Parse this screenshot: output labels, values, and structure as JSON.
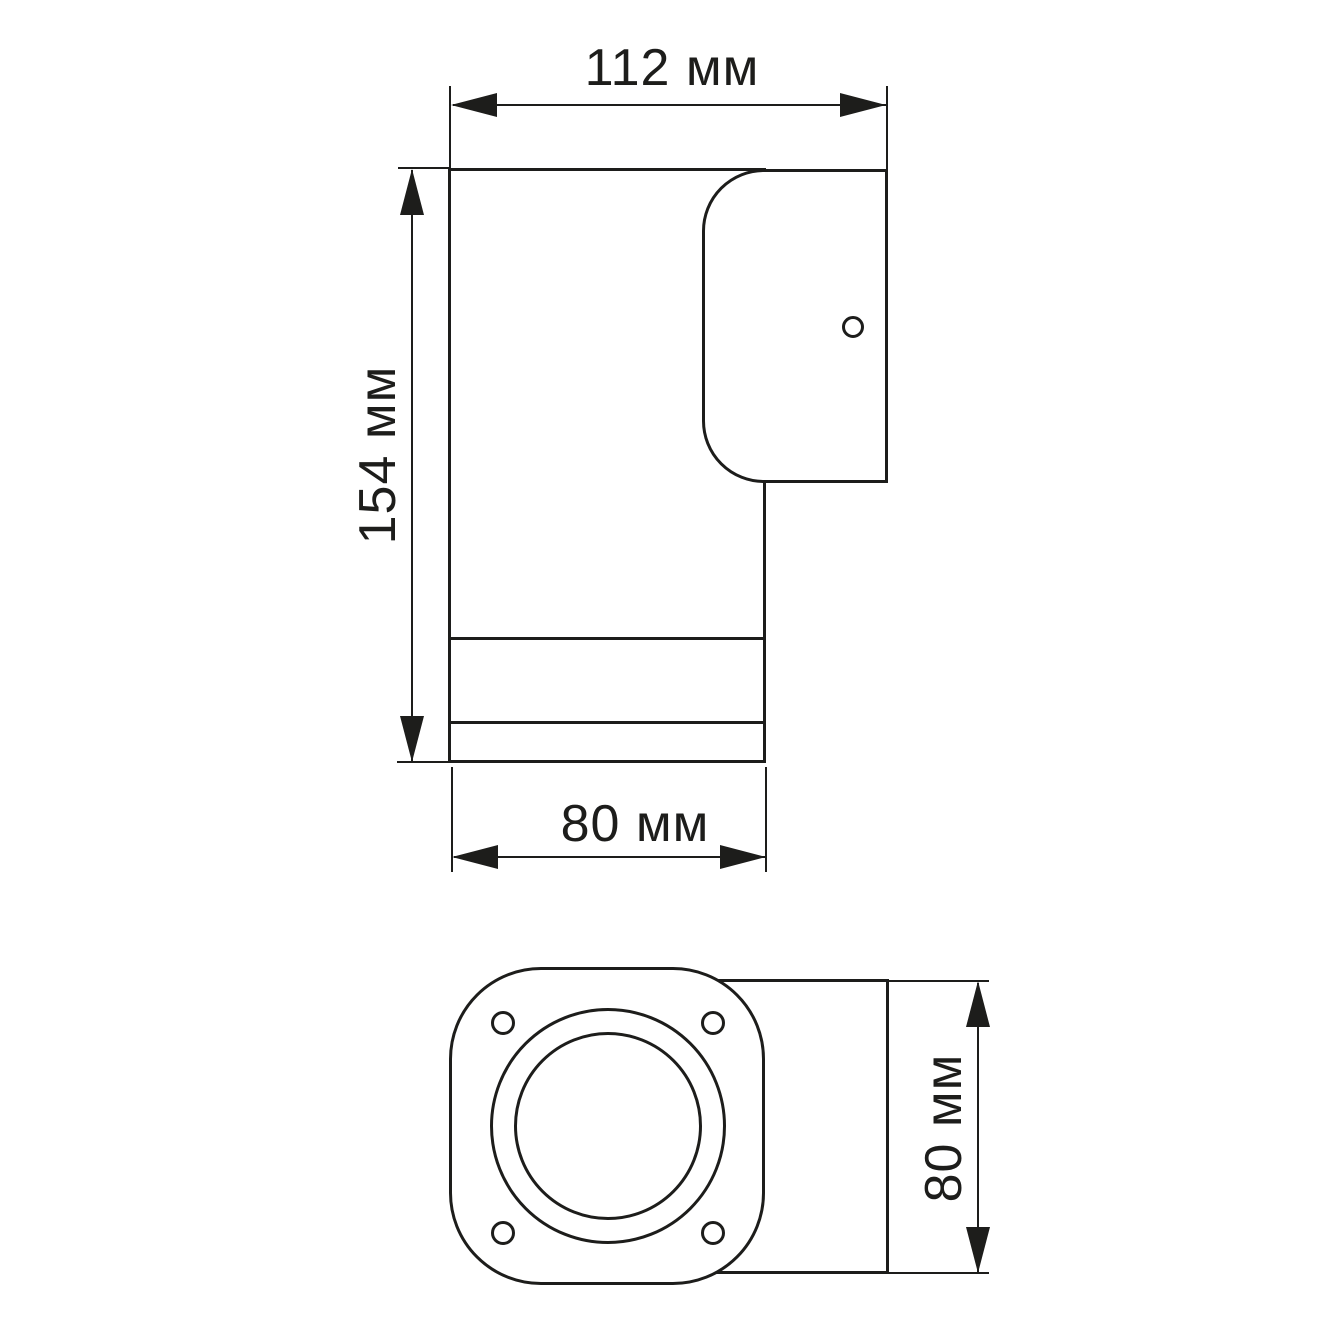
{
  "drawing": {
    "kind": "technical-dimension-drawing",
    "object": "wall-mounted cylinder lamp",
    "colors": {
      "line": "#1d1d1b",
      "background": "#ffffff"
    }
  },
  "labels": {
    "width_top": "112 мм",
    "height_left": "154 мм",
    "width_bottom": "80 мм",
    "depth_right": "80 мм"
  }
}
